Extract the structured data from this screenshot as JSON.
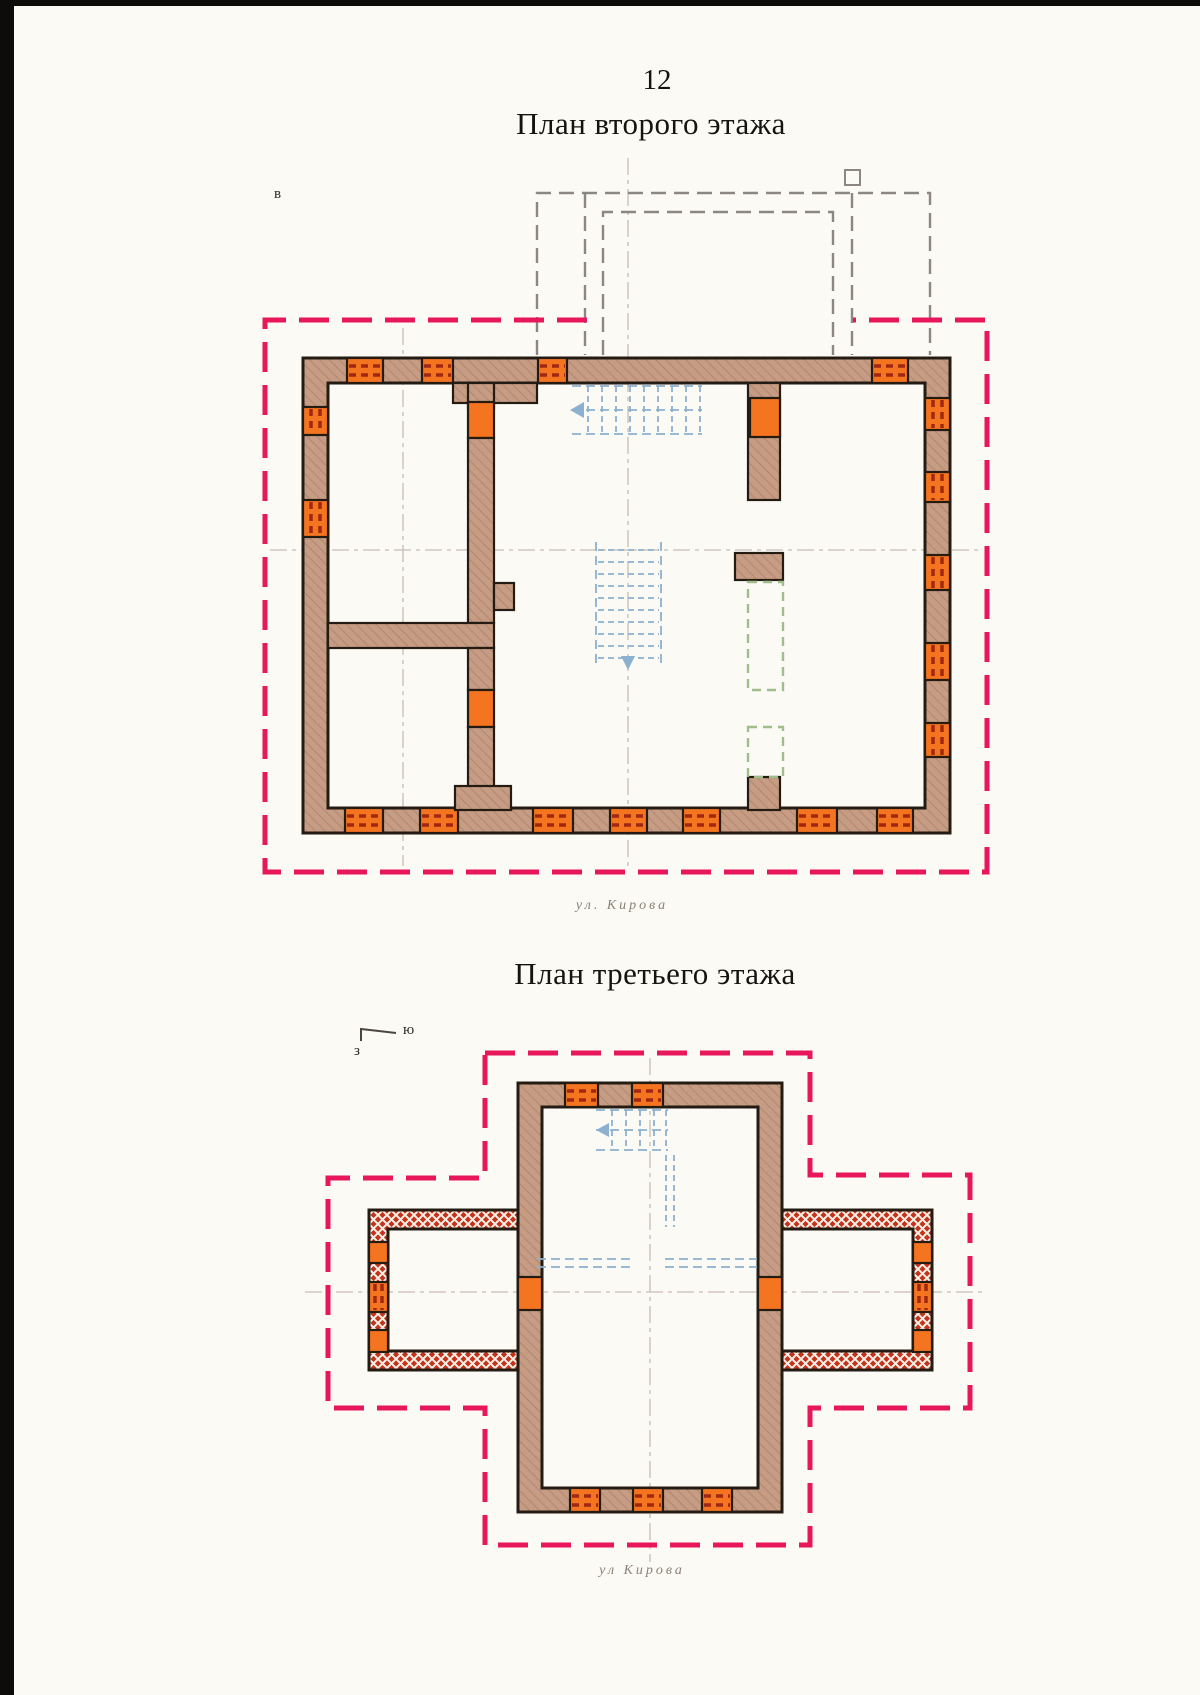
{
  "page": {
    "number": "12"
  },
  "plans": [
    {
      "title": "План второго этажа",
      "street_label": "ул. Кирова",
      "compass": {
        "east": "в"
      }
    },
    {
      "title": "План третьего этажа",
      "street_label": "ул Кирова",
      "compass": {
        "south": "ю",
        "west": "з"
      }
    }
  ],
  "colors": {
    "wall_fill": "#c69c84",
    "wall_hatch": "#b2886e",
    "outline": "#241c12",
    "window_orange": "#f5741f",
    "window_dash": "#a02812",
    "boundary_pink": "#e8175b",
    "roof_dash_gray": "#8d8781",
    "axis_gray": "#c6beb3",
    "stairs_blue": "#8cb0cf",
    "green_dash": "#9fbe8b",
    "masonry_red": "#c5331b",
    "street_text": "#8b8175",
    "page_edge_black": "#0e0c0a",
    "paper": "#fcfaf5"
  }
}
